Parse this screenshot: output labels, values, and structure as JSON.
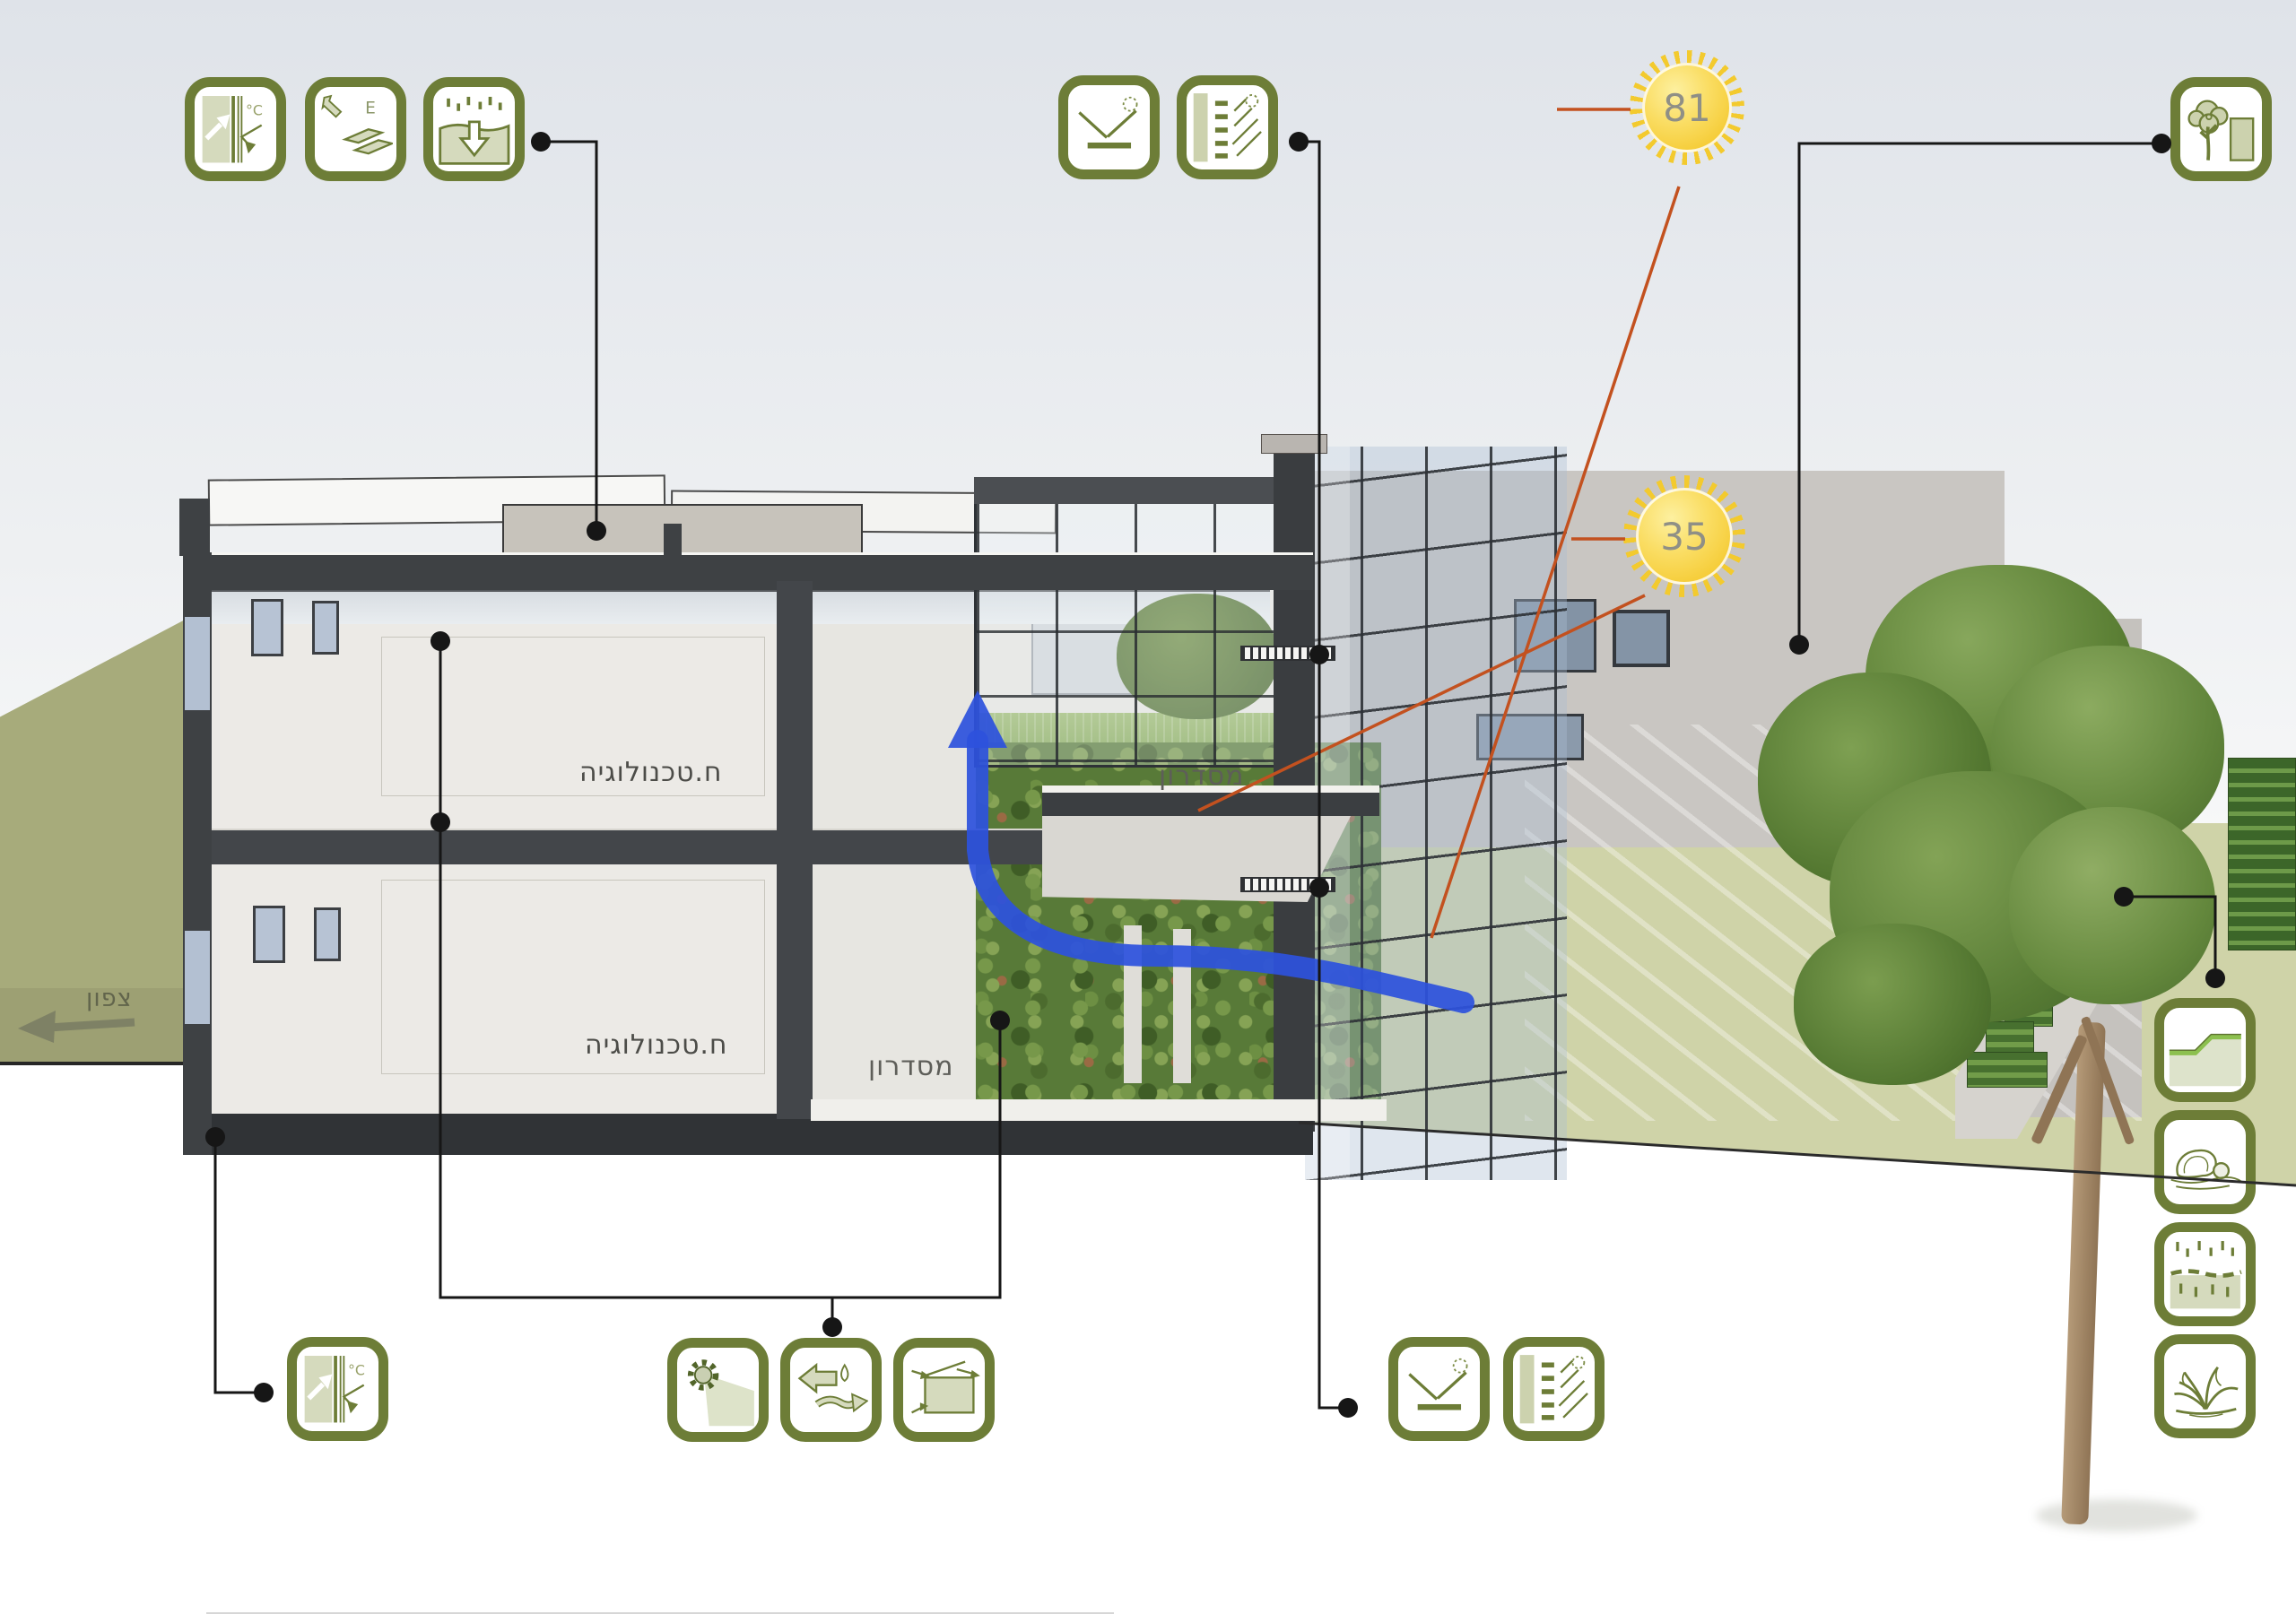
{
  "labels": {
    "north": "צפון",
    "technology_room": "ח.טכנולוגיה",
    "corridor": "מסדרון"
  },
  "suns": {
    "summer_angle": "81",
    "winter_angle": "35"
  },
  "glyph_text": {
    "temperature_unit": "°C",
    "energy_letter": "E"
  },
  "colors": {
    "icon_green": "#6d7d37",
    "icon_fill": "#d5dabd",
    "sun_yellow": "#f6cf3c",
    "sun_ray_red": "#c3511f",
    "airflow_blue": "#2d52dd",
    "ground_olive": "#a7ab7b",
    "ground_pale": "#cfd3a8",
    "leader_black": "#161616"
  },
  "icons": {
    "window_insulation": "double-glazing-thermal-insulation",
    "solar_energy": "solar-panels-energy",
    "rain_infiltration": "rainwater-infiltration",
    "light_reflection": "daylight-reflection-light-shelf",
    "shading_louvers": "sun-shading-louvers",
    "tree_shading": "tree-shading-building",
    "terrain_slope": "green-terraced-slope",
    "rocks": "landscape-rocks",
    "soil_infiltration": "soil-water-percolation",
    "vegetation": "native-planting",
    "solar_radiation": "solar-radiation-daylight",
    "air_humidity": "air-and-moisture-exchange",
    "cross_ventilation": "cross-ventilation"
  }
}
